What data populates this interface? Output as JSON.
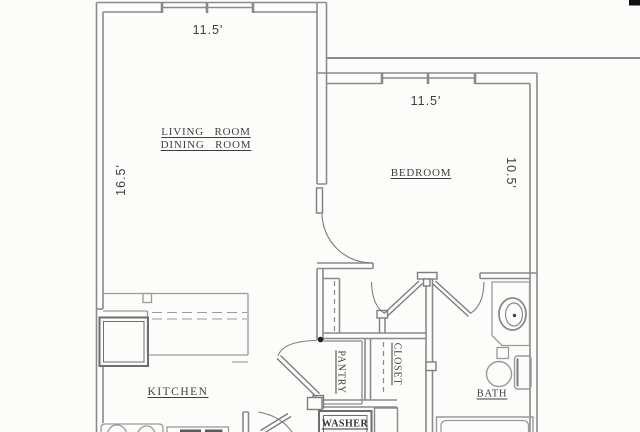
{
  "plan_labels": {
    "living_room_line1": "LIVING ROOM",
    "living_room_line2": "DINING ROOM",
    "bedroom": "BEDROOM",
    "kitchen": "KITCHEN",
    "pantry": "PANTRY",
    "closet": "CLOSET",
    "bath": "BATH",
    "washer": "WASHER"
  },
  "dimensions": {
    "living_width": "11.5'",
    "living_depth": "16.5'",
    "bedroom_width": "11.5'",
    "bedroom_depth": "10.5'"
  },
  "colors": {
    "wall_line": "#8a8a8a",
    "fixture_line": "#9a9a9a",
    "dark_line": "#6e6e6e",
    "text": "#3e3e3e",
    "background": "#fcfcfa",
    "corner_artifact": "#111111"
  }
}
